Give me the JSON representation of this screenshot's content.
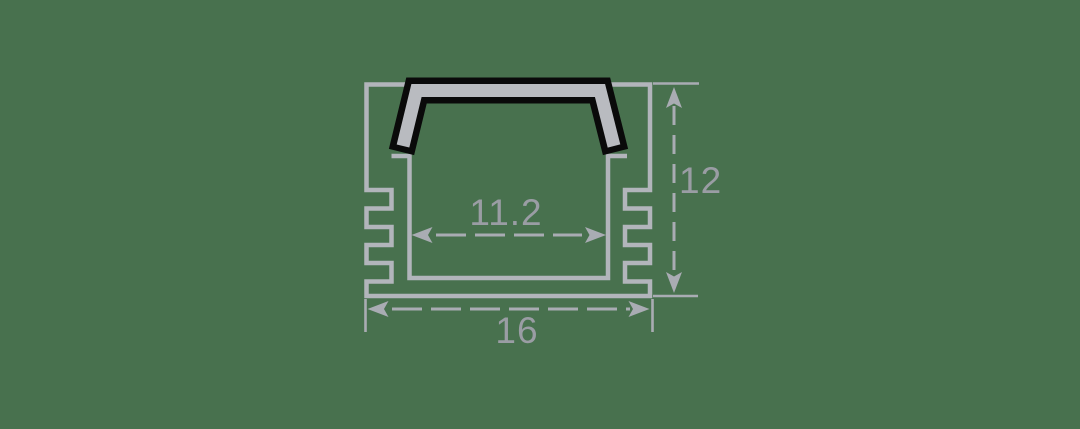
{
  "diagram": {
    "kind": "profile-cross-section-drawing",
    "dimension_labels": {
      "inner_width": "11.2",
      "outer_width": "16",
      "height": "12"
    },
    "colors": {
      "background": "#48714E",
      "body_outline": "#B2B5BB",
      "dimension_lines": "#A9ACB3",
      "dimension_text": "#9A9DA4",
      "cover_fill": "#B9BBC0",
      "cover_outline": "#0A0A0A"
    }
  }
}
